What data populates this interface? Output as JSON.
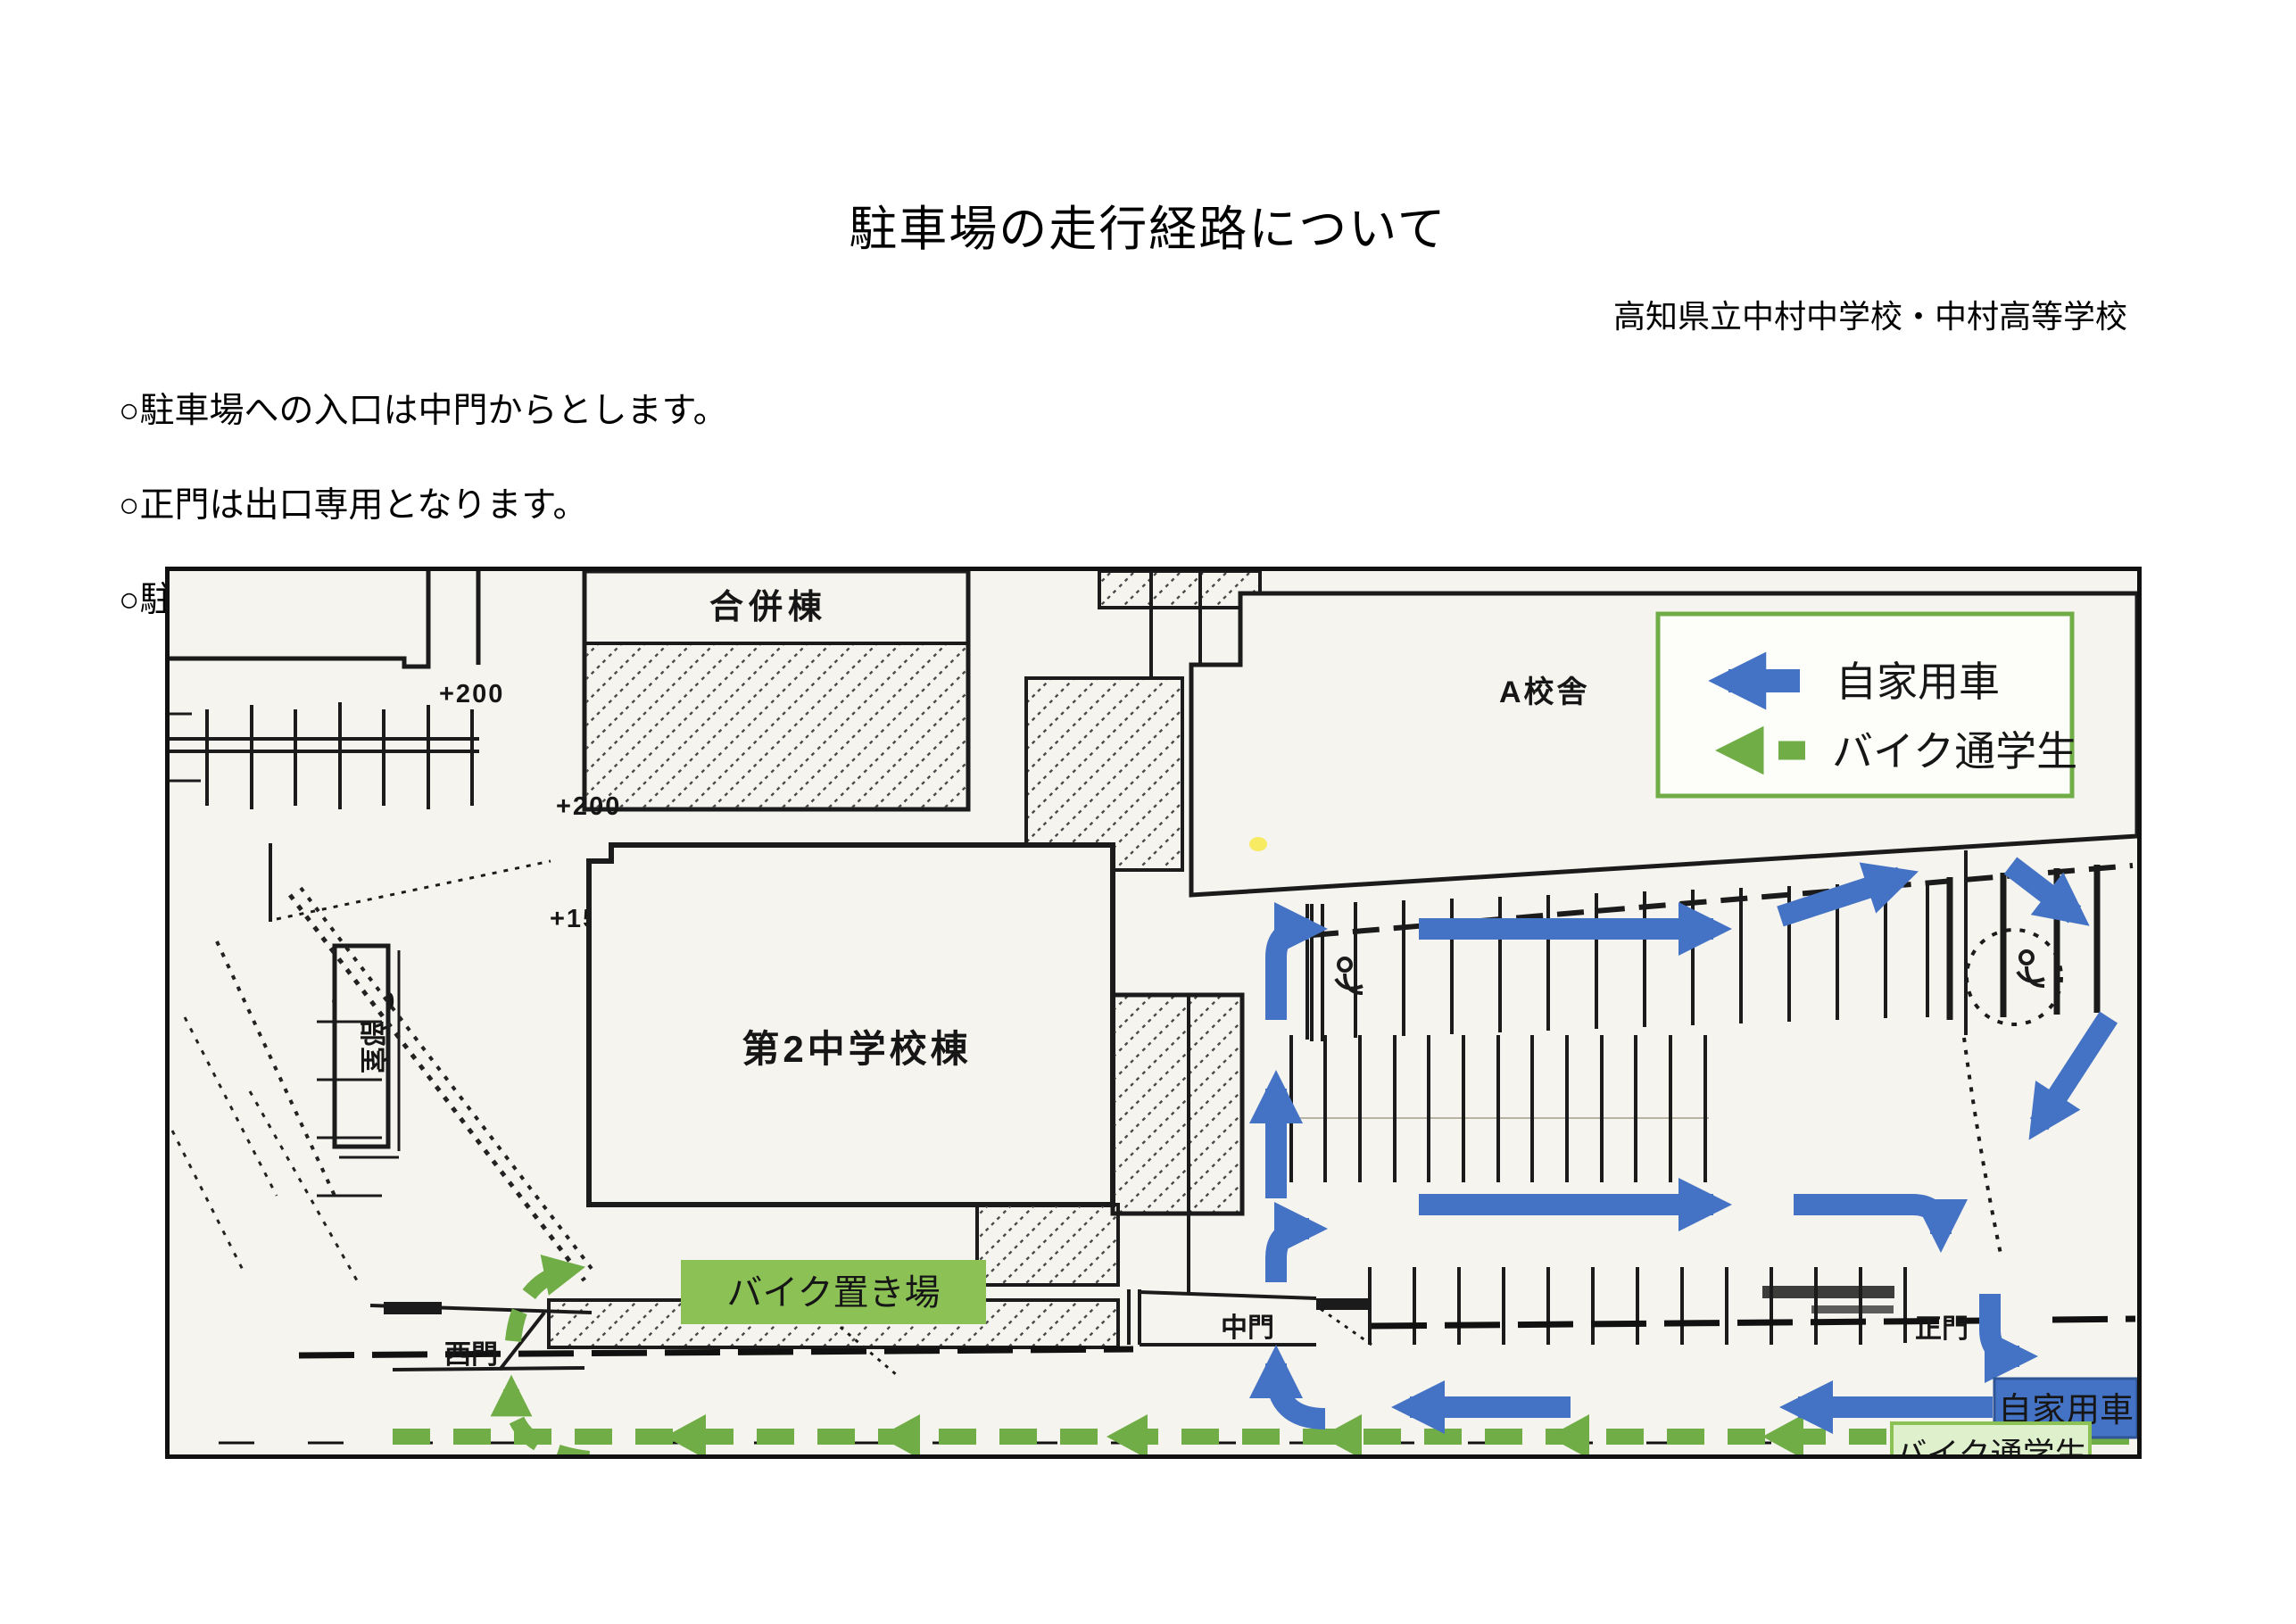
{
  "document": {
    "title": "駐車場の走行経路について",
    "school": "高知県立中村中学校・中村高等学校",
    "notes": [
      "○駐車場への入口は中門からとします。",
      "○正門は出口専用となります。",
      "○駐車場内徐行にご協力ください。"
    ]
  },
  "legend": {
    "car": "自家用車",
    "bike": "バイク通学生"
  },
  "map": {
    "buildings": {
      "gappei": "合併棟",
      "a_bldg": "A校舎",
      "jhs2": "第2中学校棟",
      "club": "部室"
    },
    "gates": {
      "west": "西門",
      "middle": "中門",
      "main": "正門"
    },
    "bike_parking": "バイク置き場",
    "exit": {
      "car": "自家用車",
      "bike": "バイク通学生"
    },
    "elevations": [
      "+200",
      "+200",
      "+150",
      "+150"
    ]
  },
  "colors": {
    "car_blue": "#4472C4",
    "car_blue_dark": "#2F5597",
    "bike_green": "#70AD47",
    "bike_box_green": "#8CC155",
    "bike_box_light": "#DFF0CC",
    "paper": "#F6F4EE"
  }
}
